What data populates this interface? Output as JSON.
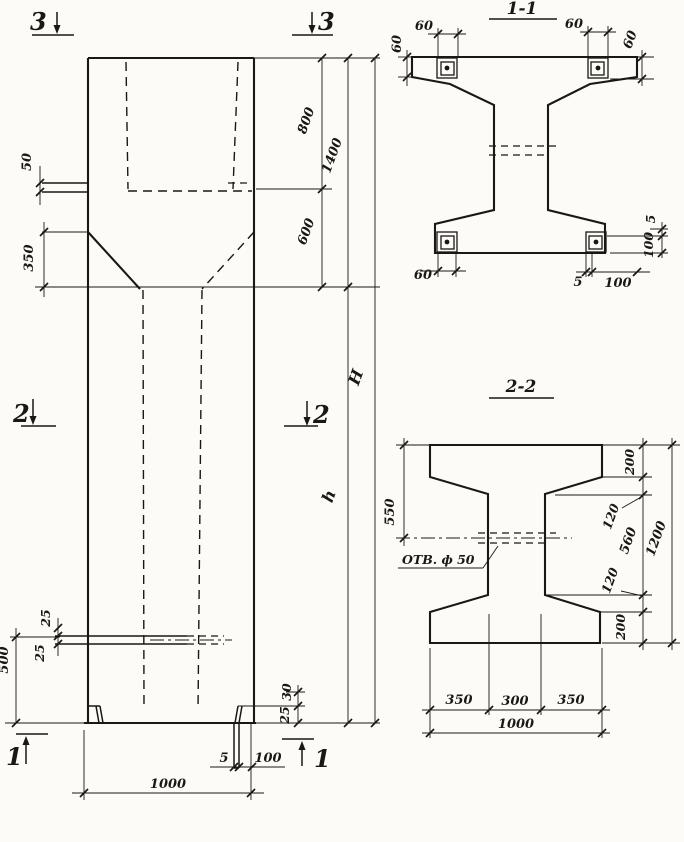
{
  "colors": {
    "ink": "#1b1713",
    "paper": "#fcfbf8"
  },
  "elevation": {
    "markers": {
      "m3_left": "3",
      "m3_right": "3",
      "m2_left": "2",
      "m2_right": "2",
      "m1_left": "1",
      "m1_right": "1"
    },
    "dims": {
      "gap50": "50",
      "offset350": "350",
      "top800": "800",
      "top1400": "1400",
      "neck600": "600",
      "total_H": "H",
      "shaft_h": "h",
      "corbel25_top": "25",
      "corbel25_bot": "25",
      "base500": "500",
      "foot30": "30",
      "foot25": "25",
      "plate5": "5",
      "plate100": "100",
      "width1000": "1000"
    }
  },
  "section11": {
    "title": "1-1",
    "dims": {
      "tl_h60": "60",
      "tl_v60": "60",
      "tr_h60": "60",
      "tr_v60": "60",
      "bl_60": "60",
      "b_5": "5",
      "b_100": "100",
      "r_5": "5",
      "r_100": "100"
    }
  },
  "section22": {
    "title": "2-2",
    "hole_label": "ОТВ. ф 50",
    "dims": {
      "left550": "550",
      "r200_top": "200",
      "r120_top": "120",
      "r560": "560",
      "r120_bot": "120",
      "r200_bot": "200",
      "r1200": "1200",
      "b350_left": "350",
      "b300": "300",
      "b350_right": "350",
      "b1000": "1000"
    }
  }
}
